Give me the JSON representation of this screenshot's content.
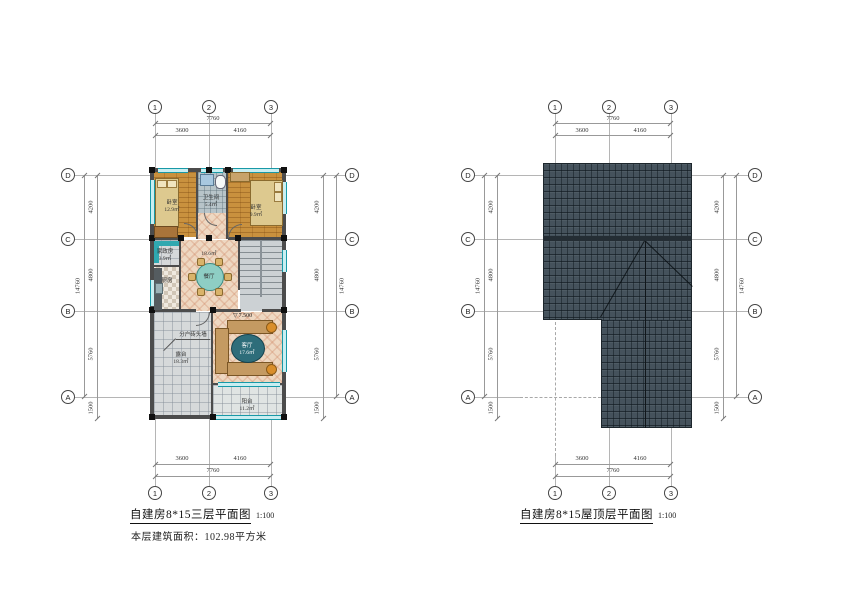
{
  "left": {
    "title": "自建房8*15三层平面图",
    "scale": "1:100",
    "area_note": "本层建筑面积：102.98平方米",
    "cols": [
      "1",
      "2",
      "3"
    ],
    "rows": [
      "D",
      "C",
      "B",
      "A"
    ],
    "dims": {
      "top_total": "7760",
      "top_segs": [
        "3600",
        "4160"
      ],
      "side_total": "14760",
      "side_segs": [
        "4200",
        "4800",
        "5760",
        "1500"
      ]
    },
    "level_symbol": "▽",
    "level_mark": "7.500",
    "wall_note": "分户砖头墙",
    "rooms": {
      "bedroom1": {
        "label": "卧室",
        "area": "12.9㎡"
      },
      "bath": {
        "label": "卫生间",
        "area": "5.4㎡"
      },
      "bedroom2": {
        "label": "卧室",
        "area": "9.9㎡"
      },
      "laundry": {
        "label": "家政房",
        "area": "3.9㎡"
      },
      "kitchen": {
        "label": "厨房"
      },
      "dining": {
        "label": "餐厅",
        "area": "18.6㎡"
      },
      "terrace": {
        "label": "露台",
        "area": "18.3㎡"
      },
      "living": {
        "label": "客厅",
        "area": "17.6㎡"
      },
      "balcony": {
        "label": "阳台",
        "area": "11.2㎡"
      }
    }
  },
  "right": {
    "title": "自建房8*15屋顶层平面图",
    "scale": "1:100",
    "cols": [
      "1",
      "2",
      "3"
    ],
    "rows": [
      "D",
      "C",
      "B",
      "A"
    ],
    "dims": {
      "top_total": "7760",
      "top_segs": [
        "3600",
        "4160"
      ],
      "side_total": "14760",
      "side_segs": [
        "4200",
        "4800",
        "5760",
        "1500"
      ]
    },
    "eave_dim": "300"
  },
  "colors": {
    "roof": "#45525c",
    "window": "#2fb0bd",
    "wood_floor": "#c9913e",
    "mosaic_floor": "#eed8c2",
    "wall": "#4c4c4c"
  }
}
